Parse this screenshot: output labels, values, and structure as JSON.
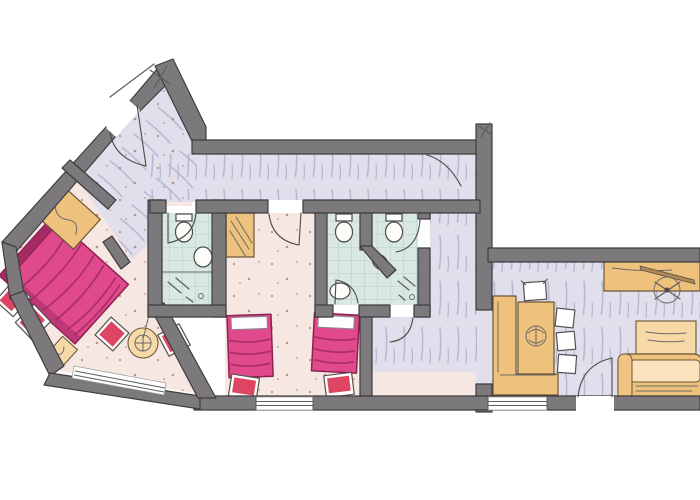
{
  "document": {
    "kind": "hand-drawn watercolor architectural floor plan sketch",
    "visible_text": [],
    "orientation": "apartment with a rotated bedroom wing at the upper left and a straight main block to the right"
  },
  "palette": {
    "wall": "#7c797c",
    "wall_stroke": "#3f3c3f",
    "ink": "#4a4a4a",
    "corridor_floor": "#e0dfeb",
    "hatch": "#b9b7cf",
    "bedroom_floor": "#f7e7e3",
    "speckle": "#c09080",
    "bath_floor": "#d9e8e4",
    "bath_grid": "#abc7c0",
    "bed_pink": "#e04a8c",
    "bed_pink_dark": "#a32a62",
    "bed_outline": "#8d2050",
    "chair_red": "#dd4563",
    "stool_pink": "#e45d9f",
    "tan": "#eec27c",
    "tan_light": "#f6d9a6",
    "tan_stroke": "#6b5636",
    "window_line": "#5d5d5d"
  },
  "rooms": [
    {
      "name": "master-bedroom",
      "floor": "pink watercolor with speckles",
      "furniture": [
        "double-bed",
        "wardrobe-with-hanger",
        "armchair",
        "armchair",
        "bedside-table-with-lamp",
        "round-table",
        "stool",
        "stool",
        "window-band"
      ]
    },
    {
      "name": "entry-hallway",
      "floor": "lavender watercolor with hatch strokes",
      "furniture": [
        "entrance-door",
        "interior-door"
      ]
    },
    {
      "name": "bathroom-1",
      "floor": "pale blue tiles",
      "furniture": [
        "toilet",
        "washbasin",
        "shower"
      ]
    },
    {
      "name": "kids-bedroom",
      "floor": "pink watercolor with speckles",
      "furniture": [
        "closet-niche",
        "single-bed",
        "single-bed",
        "chair",
        "chair",
        "window"
      ]
    },
    {
      "name": "bathroom-2",
      "floor": "pale blue tiles",
      "furniture": [
        "toilet",
        "washbasin",
        "door"
      ]
    },
    {
      "name": "bathroom-3",
      "floor": "pale blue tiles",
      "furniture": [
        "toilet",
        "corner-washbasin",
        "shower",
        "door"
      ]
    },
    {
      "name": "rear-hall",
      "floor": "lavender and pink watercolor",
      "furniture": [
        "door-to-bathroom"
      ]
    },
    {
      "name": "living-dining-room",
      "floor": "lavender watercolor with hatch strokes",
      "furniture": [
        "corner-bench",
        "dining-table-with-centerpiece",
        "dining-chair",
        "dining-chair",
        "dining-chair",
        "dining-chair",
        "desk-with-pencil",
        "swivel-desk-chair",
        "coffee-table",
        "sofa",
        "terrace-door",
        "window"
      ]
    }
  ]
}
